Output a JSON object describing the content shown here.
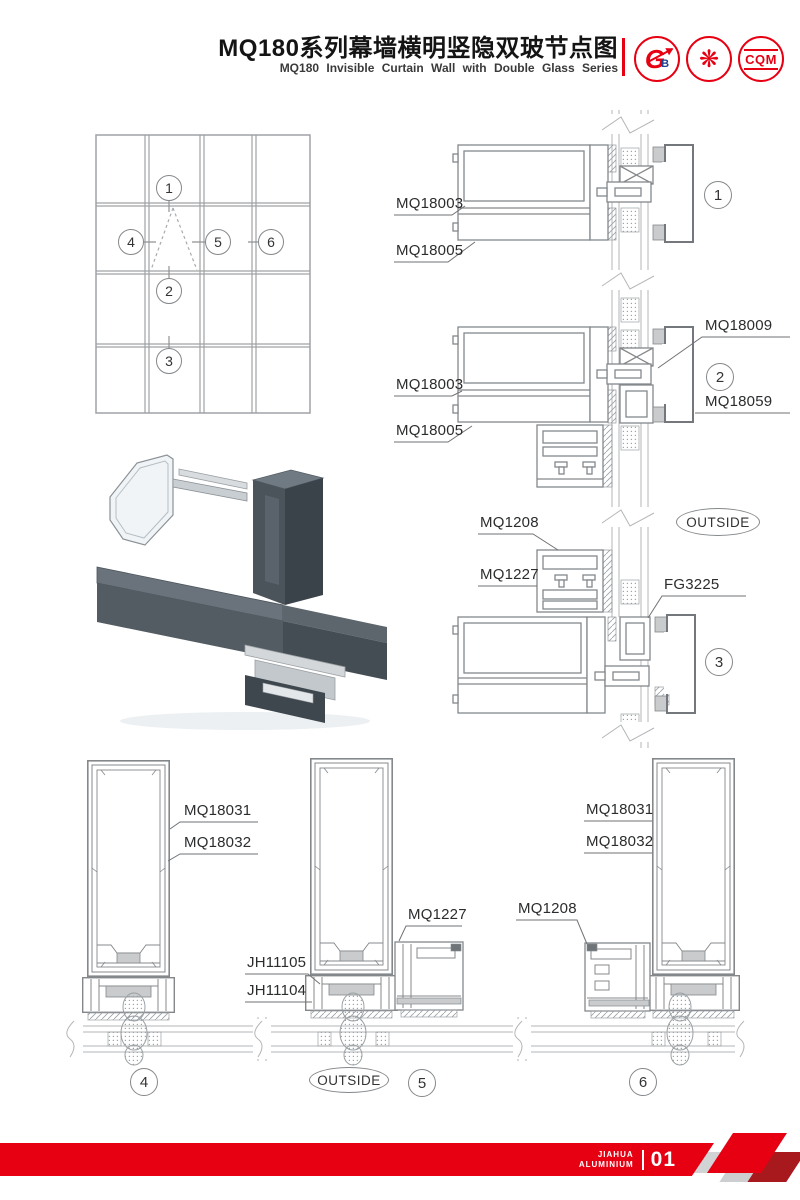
{
  "header": {
    "title_cn": "MQ180系列幕墙横明竖隐双玻节点图",
    "title_en": "MQ180 Invisible Curtain Wall with Double Glass Series",
    "logos": {
      "gtb": {
        "primary": "G",
        "accent": "B"
      },
      "seal": {
        "primary": "❋"
      },
      "cqm": {
        "primary": "CQM"
      }
    }
  },
  "elevation": {
    "callouts": {
      "c1": "1",
      "c2": "2",
      "c3": "3",
      "c4": "4",
      "c5": "5",
      "c6": "6"
    }
  },
  "details": {
    "outside": "OUTSIDE",
    "callouts": {
      "c1": "1",
      "c2": "2",
      "c3": "3",
      "c4": "4",
      "c5": "5",
      "c6": "6"
    },
    "labels": {
      "d1_main": "MQ18003",
      "d1_cap": "MQ18005",
      "d2_main": "MQ18003",
      "d2_cap": "MQ18005",
      "d2_vent": "MQ18009",
      "d2_block": "MQ18059",
      "mid_top": "MQ1208",
      "mid_bottom": "MQ1227",
      "mid_glass": "FG3225",
      "b4_outer": "MQ18031",
      "b4_inner": "MQ18032",
      "b5_clip_top": "JH11105",
      "b5_clip_bottom": "JH11104",
      "b5_transom": "MQ1227",
      "b6_outer": "MQ18031",
      "b6_inner": "MQ18032",
      "b6_transom": "MQ1208"
    }
  },
  "footer": {
    "brand_line1": "JIAHUA",
    "brand_line2": "ALUMINIUM",
    "page_number": "01"
  },
  "colors": {
    "brand_red": "#e60012"
  }
}
